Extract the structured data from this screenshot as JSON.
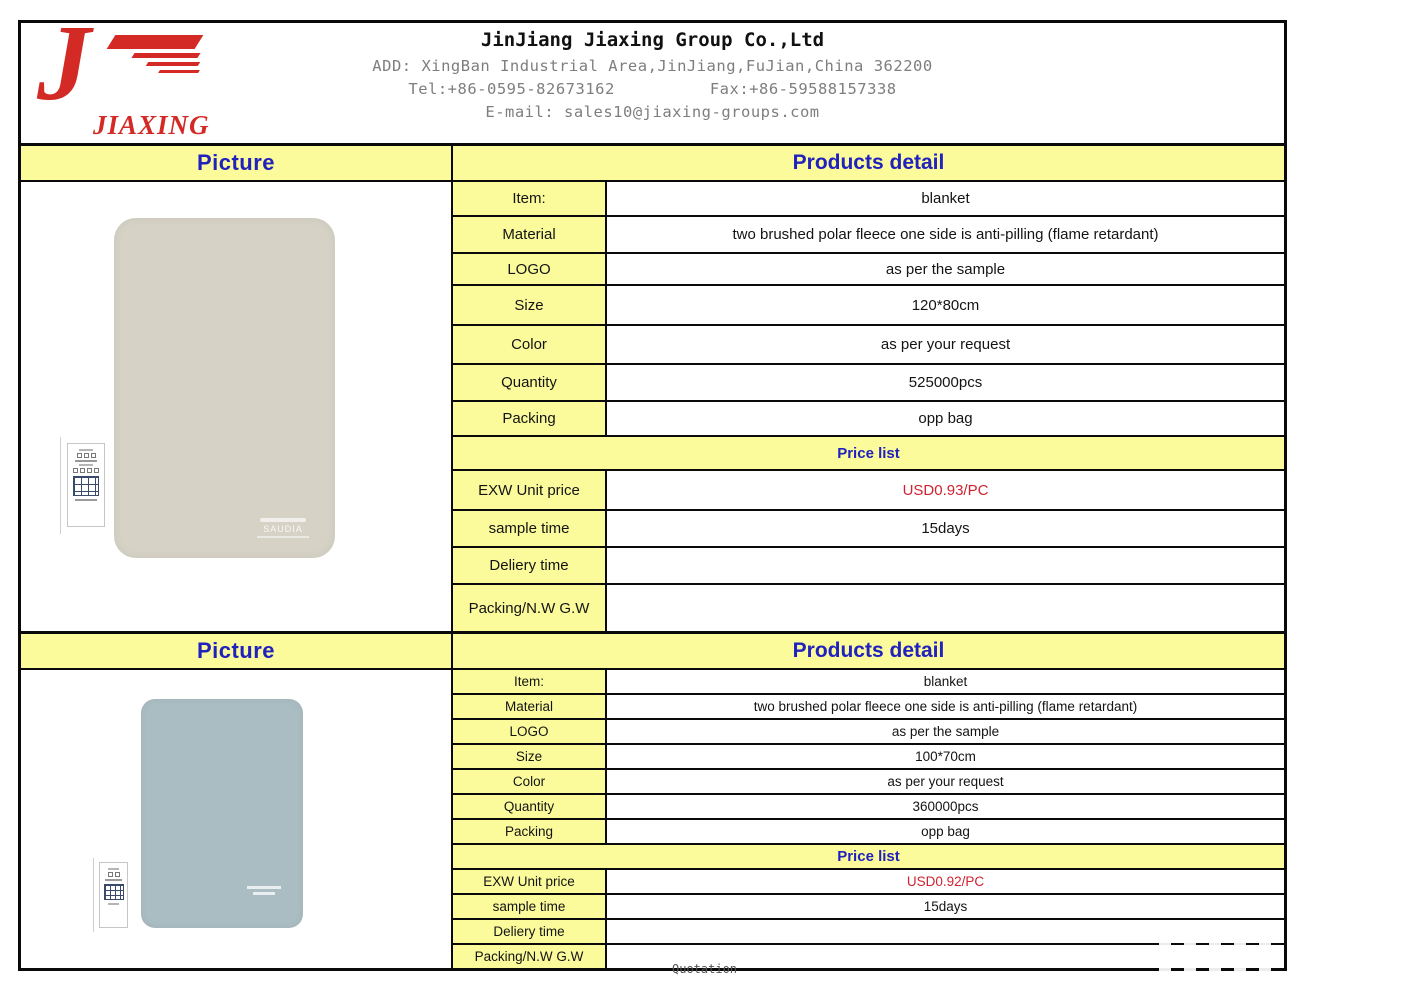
{
  "header": {
    "company_name": "JinJiang Jiaxing Group Co.,Ltd",
    "address": "ADD: XingBan Industrial Area,JinJiang,FuJian,China 362200",
    "tel": "Tel:+86-0595-82673162",
    "fax": "Fax:+86-59588157338",
    "email": "E-mail: sales10@jiaxing-groups.com",
    "logo_text": "JIAXING"
  },
  "products": [
    {
      "picture_header": "Picture",
      "detail_header": "Products detail",
      "brand_mark": "SAUDIA",
      "rows": [
        {
          "label": "Item:",
          "value": "blanket"
        },
        {
          "label": "Material",
          "value": "two brushed polar fleece one side is anti-pilling (flame retardant)"
        },
        {
          "label": "LOGO",
          "value": "as per the sample"
        },
        {
          "label": "Size",
          "value": "120*80cm"
        },
        {
          "label": "Color",
          "value": "as per your request"
        },
        {
          "label": "Quantity",
          "value": "525000pcs"
        },
        {
          "label": "Packing",
          "value": "opp bag"
        }
      ],
      "price_list_header": "Price list",
      "price_rows": [
        {
          "label": "EXW Unit price",
          "value": "USD0.93/PC"
        },
        {
          "label": "sample time",
          "value": "15days"
        },
        {
          "label": "Deliery time",
          "value": ""
        },
        {
          "label": "Packing/N.W G.W",
          "value": ""
        }
      ]
    },
    {
      "picture_header": "Picture",
      "detail_header": "Products detail",
      "rows": [
        {
          "label": "Item:",
          "value": "blanket"
        },
        {
          "label": "Material",
          "value": "two brushed polar fleece one side is anti-pilling (flame retardant)"
        },
        {
          "label": "LOGO",
          "value": "as per the sample"
        },
        {
          "label": "Size",
          "value": "100*70cm"
        },
        {
          "label": "Color",
          "value": "as per your request"
        },
        {
          "label": "Quantity",
          "value": "360000pcs"
        },
        {
          "label": "Packing",
          "value": "opp bag"
        }
      ],
      "price_list_header": "Price list",
      "price_rows": [
        {
          "label": "EXW Unit price",
          "value": "USD0.92/PC"
        },
        {
          "label": "sample time",
          "value": "15days"
        },
        {
          "label": "Deliery time",
          "value": ""
        },
        {
          "label": "Packing/N.W G.W",
          "value": ""
        }
      ]
    }
  ],
  "footer": {
    "sheet_label": "Quotation"
  },
  "colors": {
    "accent_yellow": "#fbfb9b",
    "accent_blue": "#2121be",
    "price_red": "#cf2330",
    "logo_red": "#d32a26",
    "blanket1": "#d6d2c6",
    "blanket2": "#aabdc3"
  }
}
